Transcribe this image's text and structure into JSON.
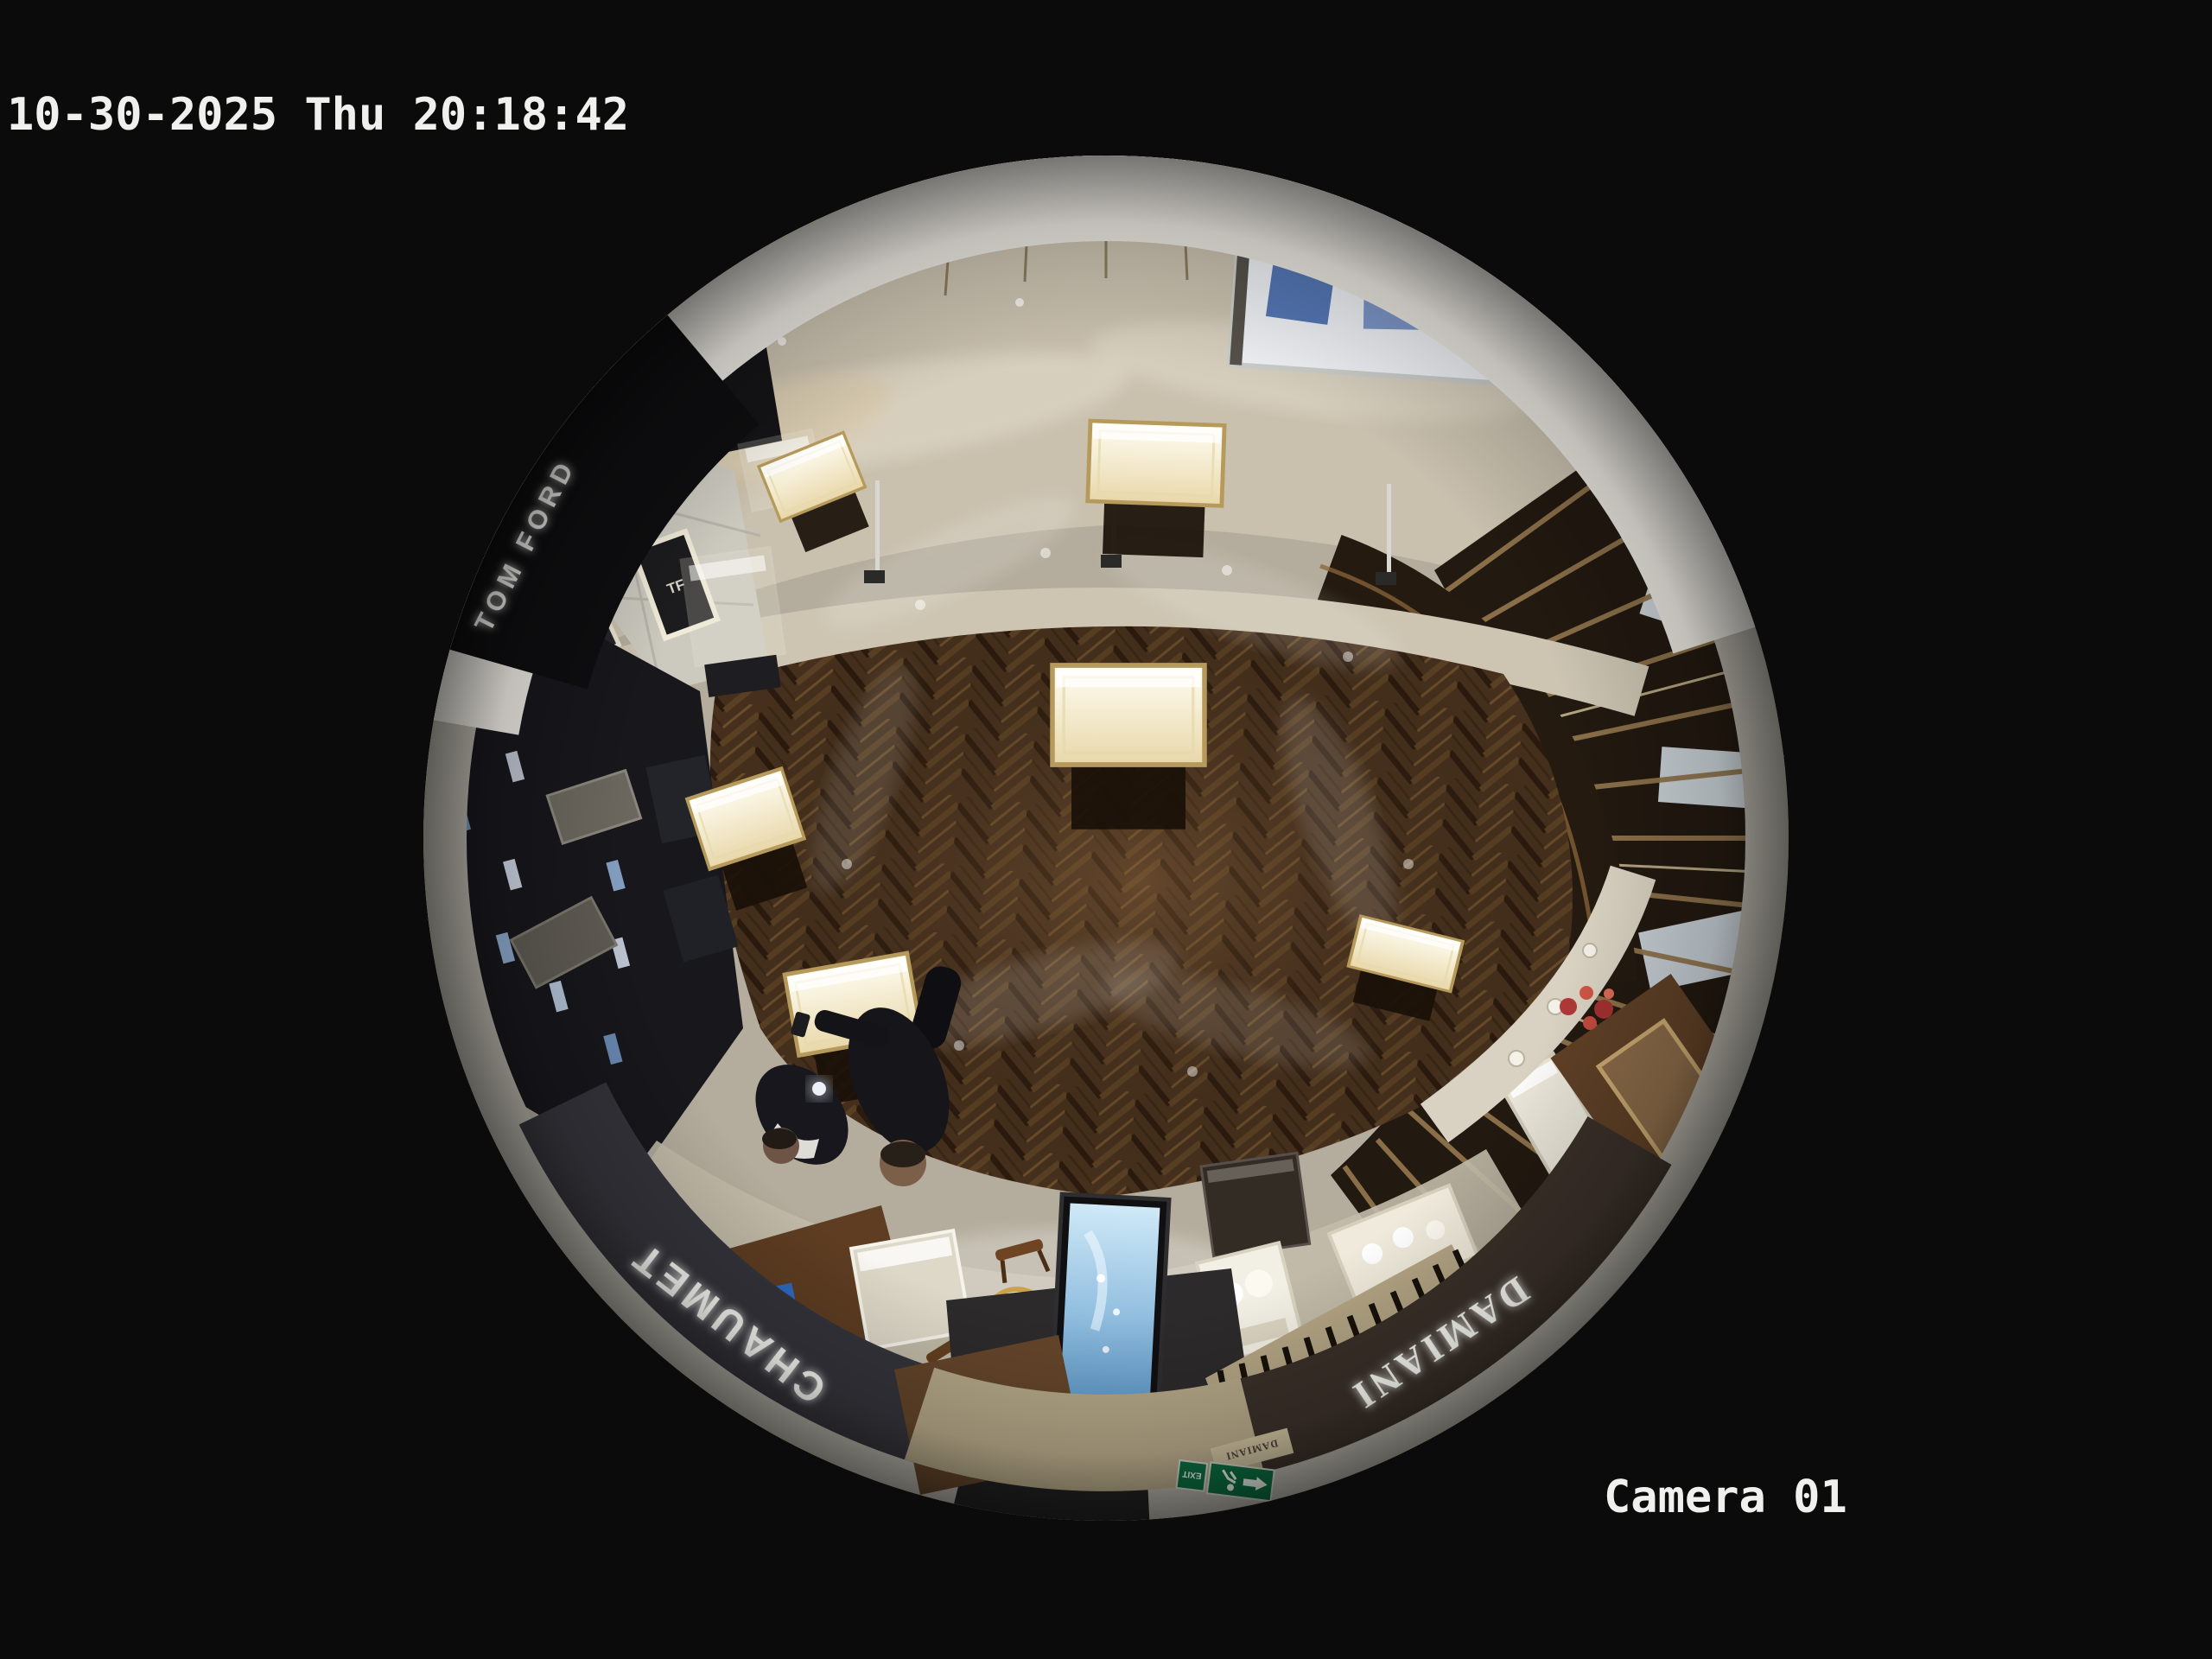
{
  "osd": {
    "timestamp": "10-30-2025 Thu 20:18:42",
    "camera_label": "Camera 01",
    "text_color": "#f0f0ee"
  },
  "scene": {
    "description": "Overhead 360-degree fisheye CCTV view of a luxury jewellery boutique adjoining a mall corridor",
    "signs": {
      "chaumet_fascia": "CHAUMET",
      "chaumet_glass": "CHAUMET",
      "chaumet_screen": "CHAUMET",
      "damiani_fascia": "DAMIANI",
      "damiani_plaque": "DAMIANI",
      "tom_ford_fascia": "TOM FORD",
      "tf_monogram": "TF",
      "wall_letters": "A.BORGH",
      "exit_sign": "EXIT"
    },
    "colors": {
      "background": "#0b0b0b",
      "rim_ceiling": "#ebe8e1",
      "rim_band": "#b7b4aa",
      "corridor_marble": "#c9c0ae",
      "boutique_stone": "#b4ad9d",
      "herringbone_wood": "#46301d",
      "chaumet_fascia": "#34343b",
      "damiani_fascia": "#3a3029",
      "tomford_fascia": "#0e0e10",
      "exit_green": "#0c6e40",
      "screen_blue": "#5795c8",
      "counter_wood": "#241a10",
      "kiosk_wood": "#7a4e28"
    }
  }
}
